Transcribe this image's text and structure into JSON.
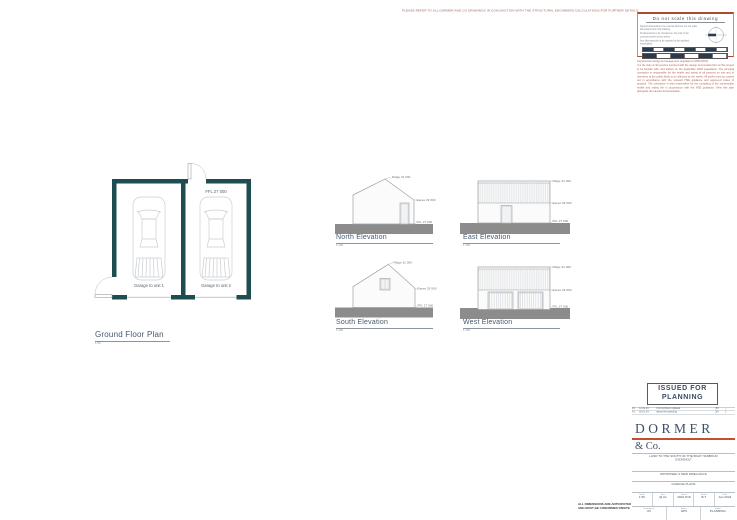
{
  "sheet": {
    "top_note": "PLEASE REFER TO ALL DORMER AND CO DRAWINGS IN CONJUNCTION WITH THE STRUCTURAL ENGINEERS CALCULATIONS FOR FURTHER DETAILS.",
    "dims_note_line1": "ALL DIMENSIONS ARE ANTICIPATED",
    "dims_note_line2": "AND MUST BE CONFIRMED ONSITE"
  },
  "scale_box": {
    "title": "Do not scale this drawing",
    "notes": [
      "Figured dimensions to be used at all times. Do not scale dimensions from this drawing.",
      "All dimensions to be checked on site prior to the commencement of any works.",
      "Any discrepancies to be reported to the architect immediately."
    ]
  },
  "cdm_note": {
    "title": "Construction design & management regulations (CDM 2015):",
    "body": "It is the duty of all persons involved with the design and construction of this project to be familiar with, and adhere to, the applicable CDM regulations. The principal contractor is responsible for the health and safety of all persons on site and of members of the public likely to be affected by the works. All works must be carried out in accordance with the relevant HSE guidance and approved codes of practice. The contractor is also responsible for the compiling of the construction health and safety file in accordance with the HSE guidance. View this plan alongside all relevant documentation."
  },
  "plan": {
    "title": "Ground Floor Plan",
    "scale": "1:50",
    "ffl_label": "FFL 27 000",
    "garage1_label": "Garage to unit 1",
    "garage2_label": "Garage to unit 2"
  },
  "elevations": {
    "north": {
      "title": "North Elevation",
      "scale": "1:100",
      "ridge": "Ridge 31 000",
      "eaves": "Eaves 29 500",
      "ffl": "FFL 27 000"
    },
    "east": {
      "title": "East Elevation",
      "scale": "1:100",
      "ridge": "Ridge 31 000",
      "eaves": "Eaves 29 500",
      "ffl": "FFL 27 000"
    },
    "south": {
      "title": "South Elevation",
      "scale": "1:100",
      "ridge": "Ridge 31 000",
      "eaves": "Eaves 29 500",
      "ffl": "FFL 27 000"
    },
    "west": {
      "title": "West Elevation",
      "scale": "1:100",
      "ridge": "Ridge 31 000",
      "eaves": "Eaves 29 500",
      "ffl": "FFL 27 000"
    }
  },
  "status_stamp": {
    "line1": "ISSUED FOR",
    "line2": "PLANNING"
  },
  "revisions": {
    "rows": [
      {
        "rev": "P2",
        "date": "12.02.24",
        "desc": "Unit numbers updated",
        "by": "BT",
        "chk": "-"
      },
      {
        "rev": "P1",
        "date": "18.01.24",
        "desc": "Issued for planning",
        "by": "BT",
        "chk": "-"
      }
    ]
  },
  "title_block": {
    "practice_name_1": "DORMER",
    "practice_name_2": "& Co.",
    "project_line_1": "LAND TO THE SOUTH OF THE BOAT HARBOUR",
    "project_line_2": "EVERSHOLT",
    "project_line_3": "PROPOSED 3 NEW DWELLINGS",
    "drawing_title": "GARAGE PLANS",
    "fields_row1": [
      {
        "label": "Scale",
        "value": "1:50"
      },
      {
        "label": "Size",
        "value": "@ A1"
      },
      {
        "label": "Job no",
        "value": "2022-P18"
      },
      {
        "label": "Drawn",
        "value": "B.T"
      },
      {
        "label": "Date",
        "value": "Jan 2024"
      }
    ],
    "fields_row2": [
      {
        "label": "Drawing no",
        "value": "04"
      },
      {
        "label": "Series",
        "value": "GP5"
      },
      {
        "label": "Status",
        "value": "PLANNING"
      }
    ],
    "riba_name": "RIBA",
    "riba_diamond": "◆",
    "riba_sub": "Chartered Practice",
    "address_line_1": "Dormer & Co. Chartered Architects Ltd",
    "address_line_2": "12 West Park, Harrogate, North Yorkshire, HG1 1BJ",
    "address_line_3": "T. 01423 500 000   W. www.dormerandco.co.uk"
  },
  "colors": {
    "wall": "#1d4d50",
    "ground": "#8c8c8c",
    "accent_red": "#c14f30",
    "brand_blue": "#3d5068"
  }
}
